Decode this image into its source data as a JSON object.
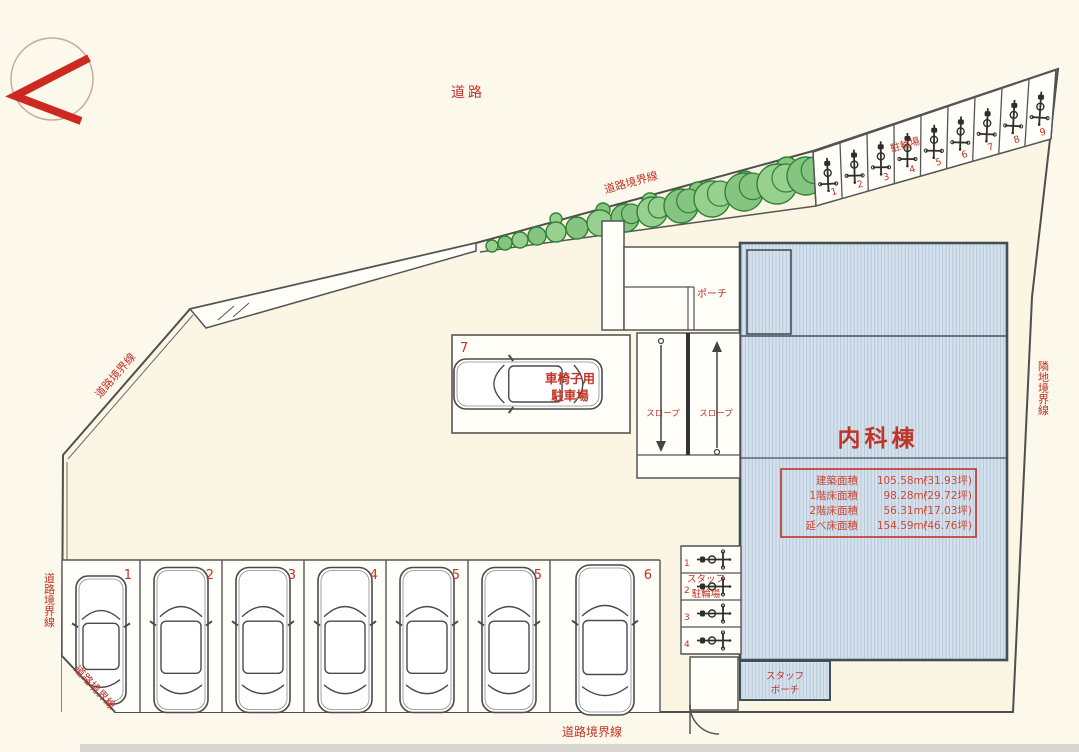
{
  "plan_type": "site-plan",
  "compass": {
    "icon": "north-arrow"
  },
  "labels": {
    "road": "道路",
    "road_boundary": "道路境界線",
    "adjacent_land_boundary": "隣地境界線",
    "bicycle_parking": "駐輪場",
    "staff_bicycle_parking_line1": "スタッフ",
    "staff_bicycle_parking_line2": "駐輪場",
    "staff_porch_line1": "スタッフ",
    "staff_porch_line2": "ポーチ",
    "porch": "ポーチ",
    "slope_left": "スロープ",
    "slope_right": "スロープ",
    "wheelchair_line1": "車椅子用",
    "wheelchair_line2": "駐車場"
  },
  "building": {
    "name": "内科棟",
    "area_table": [
      {
        "label": "建築面積",
        "value": "105.58m²",
        "tsubo": "(31.93坪)"
      },
      {
        "label": "1階床面積",
        "value": "98.28m²",
        "tsubo": "(29.72坪)"
      },
      {
        "label": "2階床面積",
        "value": "56.31m²",
        "tsubo": "(17.03坪)"
      },
      {
        "label": "延べ床面積",
        "value": "154.59m²",
        "tsubo": "(46.76坪)"
      }
    ]
  },
  "parking": {
    "car_stall_numbers": [
      "1",
      "2",
      "3",
      "4",
      "5",
      "5",
      "6"
    ],
    "wheelchair_stall_number": "7"
  },
  "bicycles": {
    "road_side_stall_numbers": [
      "1",
      "2",
      "3",
      "4",
      "5",
      "6",
      "7",
      "8",
      "9"
    ],
    "staff_stall_numbers": [
      "1",
      "2",
      "3",
      "4"
    ]
  },
  "colors": {
    "red": "#c13427",
    "line": "#4f4f4f",
    "line_dark": "#3c3c3c",
    "building_fill": "#d5e2ee",
    "building_hatch": "#b2c6da",
    "building_border": "#3f4e57",
    "tree_fill": "#85c481",
    "tree_fill2": "#97d08f",
    "tree_stroke": "#2f8136",
    "bg": "#fcf8ec",
    "site_fill": "#fbf6e3",
    "white": "#fffef8",
    "gray_band": "#d8d6d0",
    "compass_ring": "#c8ad92",
    "compass_arrow": "#cc2920"
  }
}
